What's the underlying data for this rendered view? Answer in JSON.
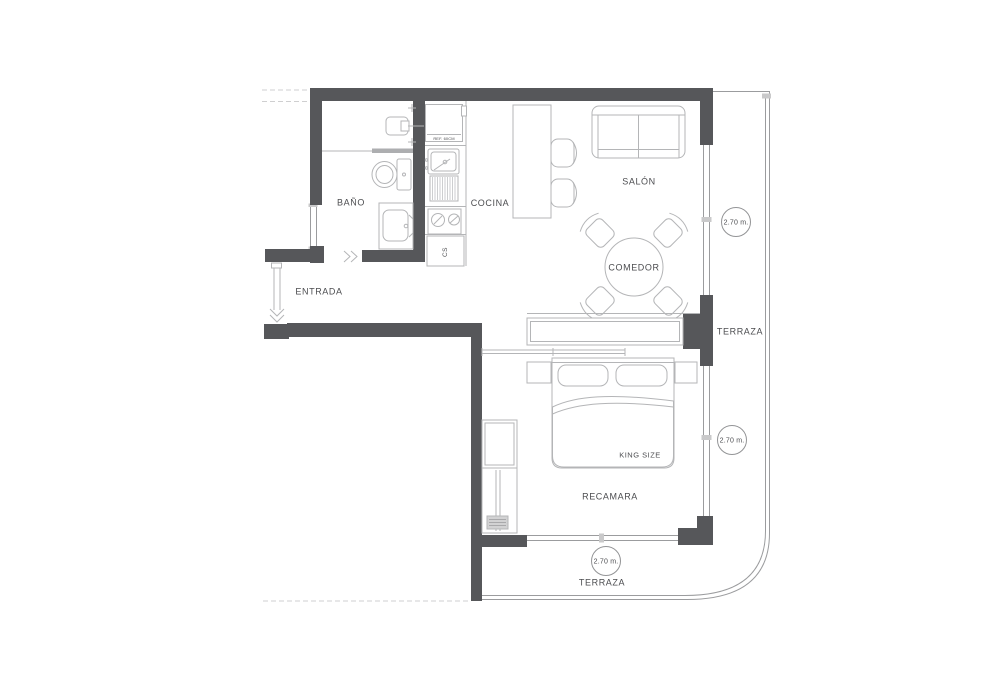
{
  "plan": {
    "rooms": {
      "bano": "BAÑO",
      "cocina": "COCINA",
      "salon": "SALÓN",
      "comedor": "COMEDOR",
      "entrada": "ENTRADA",
      "terraza_right": "TERRAZA",
      "recamara": "RECAMARA",
      "terraza_bottom": "TERRAZA"
    },
    "furniture": {
      "bed": "KING SIZE",
      "fridge": "REF. 60CM",
      "closet": "CS"
    },
    "dimensions": [
      "2.70 m.",
      "2.70 m.",
      "2.70 m."
    ],
    "colors": {
      "wall": "#56575a",
      "fixture_line": "#b4b5b7",
      "window_line": "#9b9c9e",
      "text": "#4c4d50",
      "background": "#ffffff"
    }
  }
}
